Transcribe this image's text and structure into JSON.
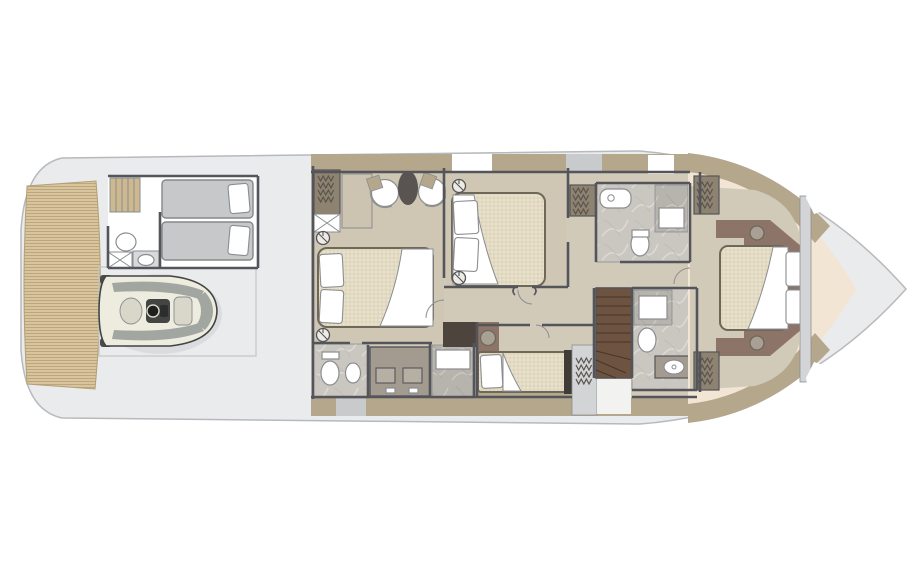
{
  "meta": {
    "label": "yacht-lower-deck-floor-plan",
    "type": "floor-plan",
    "orientation": "bow-right-stern-left",
    "visible_text": "none"
  },
  "palette": {
    "hull": "#eaebed",
    "hull_line": "#b7b9bc",
    "teak": "#d8c59e",
    "teak_line": "#b49f76",
    "floor": "#d2cab8",
    "carpet": "#cfc7b3",
    "wall": "#54555a",
    "khaki": "#b4a78c",
    "khaki_dark": "#8e8370",
    "marble": "#cac6c0",
    "marble_dark": "#b7b3ad",
    "vein": "#dedbd6",
    "white": "#ffffff",
    "fixture_line": "#8b8d90",
    "bed_stroke": "#6e6859",
    "mattress": "#e9e1cb",
    "crew_bed": "#c7c8ca",
    "crew_bed_line": "#85878a",
    "stairs_crew": "#cdb88f",
    "stairs_main": "#6e5440",
    "stairs_line": "#47352a",
    "cabinet_dark": "#4d453d",
    "headboard": "#8d7468",
    "bow_cream": "#f3e5d3",
    "stool": "#a8a094",
    "tender_hull": "#edecdf",
    "tender_deck": "#a2a6a1",
    "tender_dark": "#434543",
    "garage_line": "#c3c5c7",
    "bulkhead": "#d3d4d6",
    "block_gray": "#c9cacc",
    "hanger": "#5b544e",
    "counter": "#a39b90"
  },
  "areas": [
    {
      "name": "swim-platform",
      "finish": "teak"
    },
    {
      "name": "tender-garage",
      "fixtures": [
        "jet-tender"
      ]
    },
    {
      "name": "crew-cabin",
      "fixtures": [
        "twin-berth",
        "twin-berth",
        "crew-stairs"
      ]
    },
    {
      "name": "crew-bathroom",
      "fixtures": [
        "toilet",
        "sink",
        "storage-box"
      ]
    },
    {
      "name": "master-cabin",
      "fixtures": [
        "double-bed",
        "two-armchairs",
        "oval-table",
        "wardrobe",
        "bedside-stool",
        "bedside-stool"
      ]
    },
    {
      "name": "master-bathroom",
      "fixtures": [
        "toilet",
        "bidet",
        "double-vanity",
        "shower"
      ]
    },
    {
      "name": "vip-cabin",
      "fixtures": [
        "double-bed",
        "wardrobe",
        "bedside-stool",
        "bedside-stool"
      ]
    },
    {
      "name": "vip-bathroom",
      "fixtures": [
        "bathtub",
        "toilet",
        "shower"
      ]
    },
    {
      "name": "guest-cabin-single",
      "fixtures": [
        "single-berth",
        "washbasin",
        "wardrobe"
      ]
    },
    {
      "name": "day-head",
      "fixtures": [
        "shower",
        "toilet",
        "sink"
      ]
    },
    {
      "name": "main-staircase",
      "fixtures": [
        "wood-steps"
      ]
    },
    {
      "name": "corridor",
      "fixtures": [
        "cabinet"
      ]
    },
    {
      "name": "forward-cabin",
      "fixtures": [
        "island-double-bed",
        "wardrobe",
        "wardrobe",
        "bedside-stool",
        "bedside-stool"
      ]
    },
    {
      "name": "bow-deck",
      "finish": "gelcoat"
    }
  ]
}
